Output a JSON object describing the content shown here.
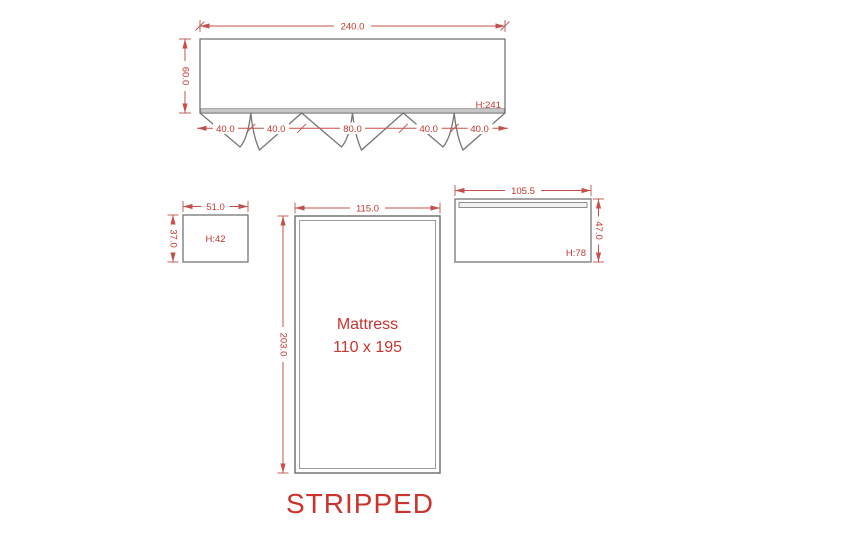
{
  "caption": "STRIPPED",
  "colors": {
    "dimension_red": "#c3504a",
    "text_red": "#c2362e",
    "outline_gray": "#757575"
  },
  "headboard": {
    "name": "headboard-with-valance",
    "width_label": "240.0",
    "height_label": "60.0",
    "height_tag": "H:241",
    "segments": [
      "40.0",
      "40.0",
      "80.0",
      "40.0",
      "40.0"
    ]
  },
  "cushion": {
    "name": "small-cushion",
    "width_label": "51.0",
    "height_label": "37.0",
    "height_tag": "H:42"
  },
  "mattress": {
    "name": "mattress",
    "width_label": "115.0",
    "height_label": "203.0",
    "label_line1": "Mattress",
    "label_line2": "110 x 195"
  },
  "footboard": {
    "name": "footboard",
    "width_label": "105.5",
    "height_label": "47.0",
    "height_tag": "H:78"
  }
}
